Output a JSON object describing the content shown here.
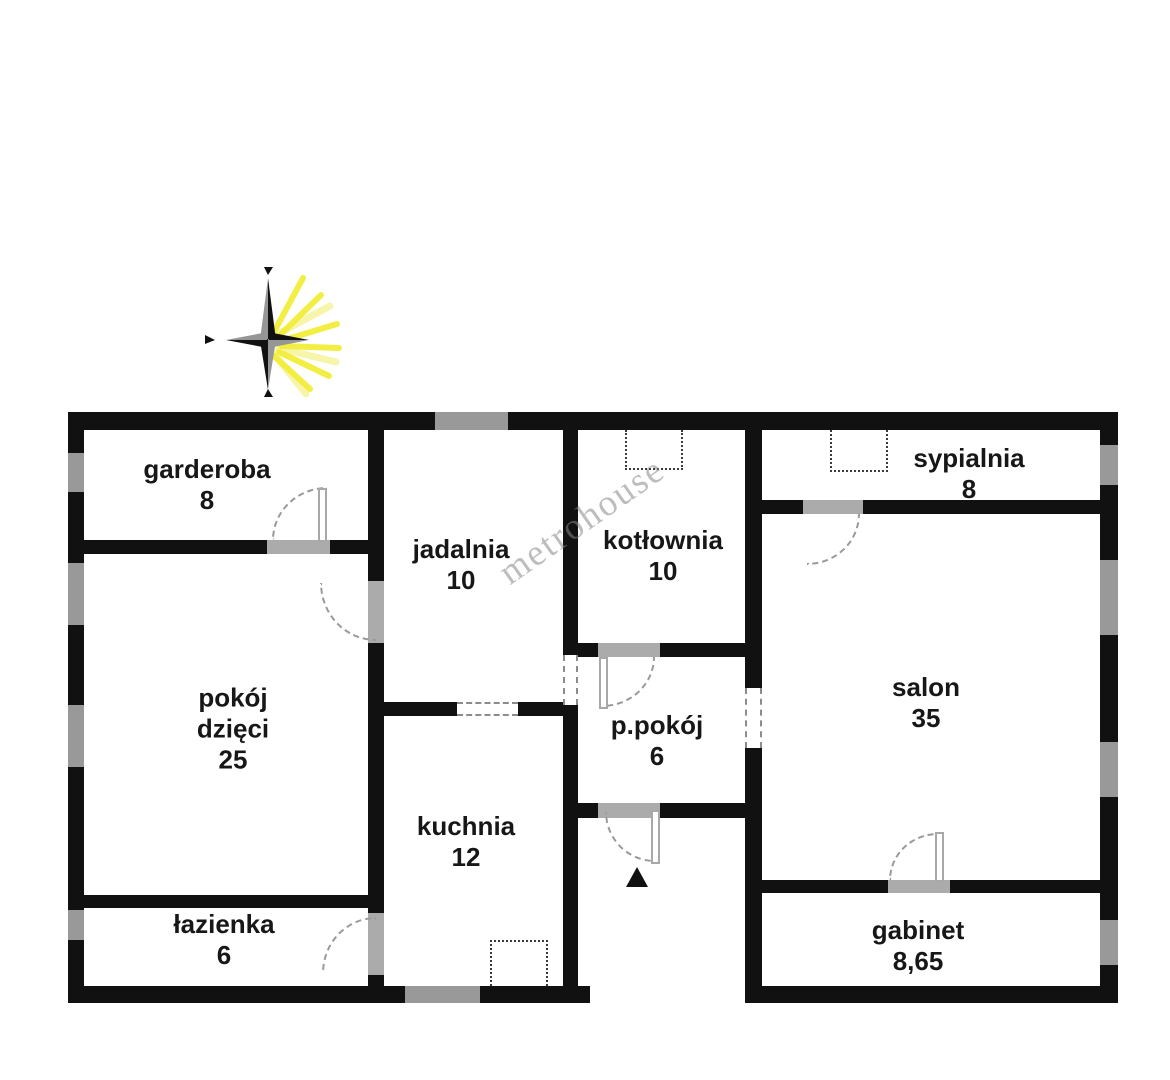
{
  "watermark": "metrohouse",
  "rooms": [
    {
      "id": "garderoba",
      "name": "garderoba",
      "area": "8"
    },
    {
      "id": "jadalnia",
      "name": "jadalnia",
      "area": "10"
    },
    {
      "id": "kotlownia",
      "name": "kotłownia",
      "area": "10"
    },
    {
      "id": "sypialnia",
      "name": "sypialnia",
      "area": "8"
    },
    {
      "id": "pokoj-dzieci",
      "name": "pokój dzięci",
      "area": "25"
    },
    {
      "id": "p-pokoj",
      "name": "p.pokój",
      "area": "6"
    },
    {
      "id": "salon",
      "name": "salon",
      "area": "35"
    },
    {
      "id": "kuchnia",
      "name": "kuchnia",
      "area": "12"
    },
    {
      "id": "lazienka",
      "name": "łazienka",
      "area": "6"
    },
    {
      "id": "gabinet",
      "name": "gabinet",
      "area": "8,65"
    }
  ],
  "colors": {
    "wall": "#111111",
    "window": "#999999",
    "door_threshold": "#ababab",
    "dashed_opening": "#8c8c8c",
    "compass_yellow": "#f2ee3b",
    "compass_dark": "#111111",
    "compass_gray": "#969696",
    "label_text": "#171717"
  }
}
